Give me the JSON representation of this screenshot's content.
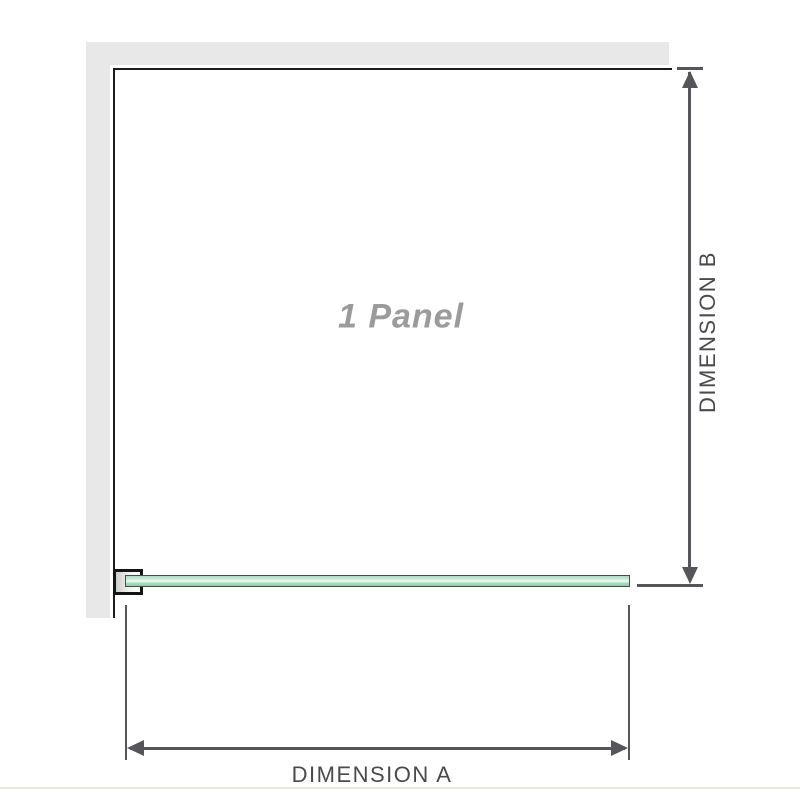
{
  "diagram": {
    "panel_label": "1 Panel",
    "dimension_a_label": "DIMENSION A",
    "dimension_b_label": "DIMENSION B"
  },
  "icons": {
    "arrow_up": "dimension-arrowhead-up",
    "arrow_down": "dimension-arrowhead-down",
    "arrow_left": "dimension-arrowhead-left",
    "arrow_right": "dimension-arrowhead-right"
  },
  "colors": {
    "background": "#ffffff",
    "wall_fill": "#e8e8e9",
    "wall_edge": "#1c1c1c",
    "dimension_line": "#55555a",
    "dimension_text": "#4a4a4d",
    "panel_text": "#9b9b9b",
    "glass_fill_light": "#a8dcbd",
    "glass_fill_highlight": "#eff9f3",
    "glass_fill_dark": "#8fcfa9",
    "glass_border": "#474c48",
    "bracket_border": "#151515",
    "baseline_line": "#eae6de"
  }
}
